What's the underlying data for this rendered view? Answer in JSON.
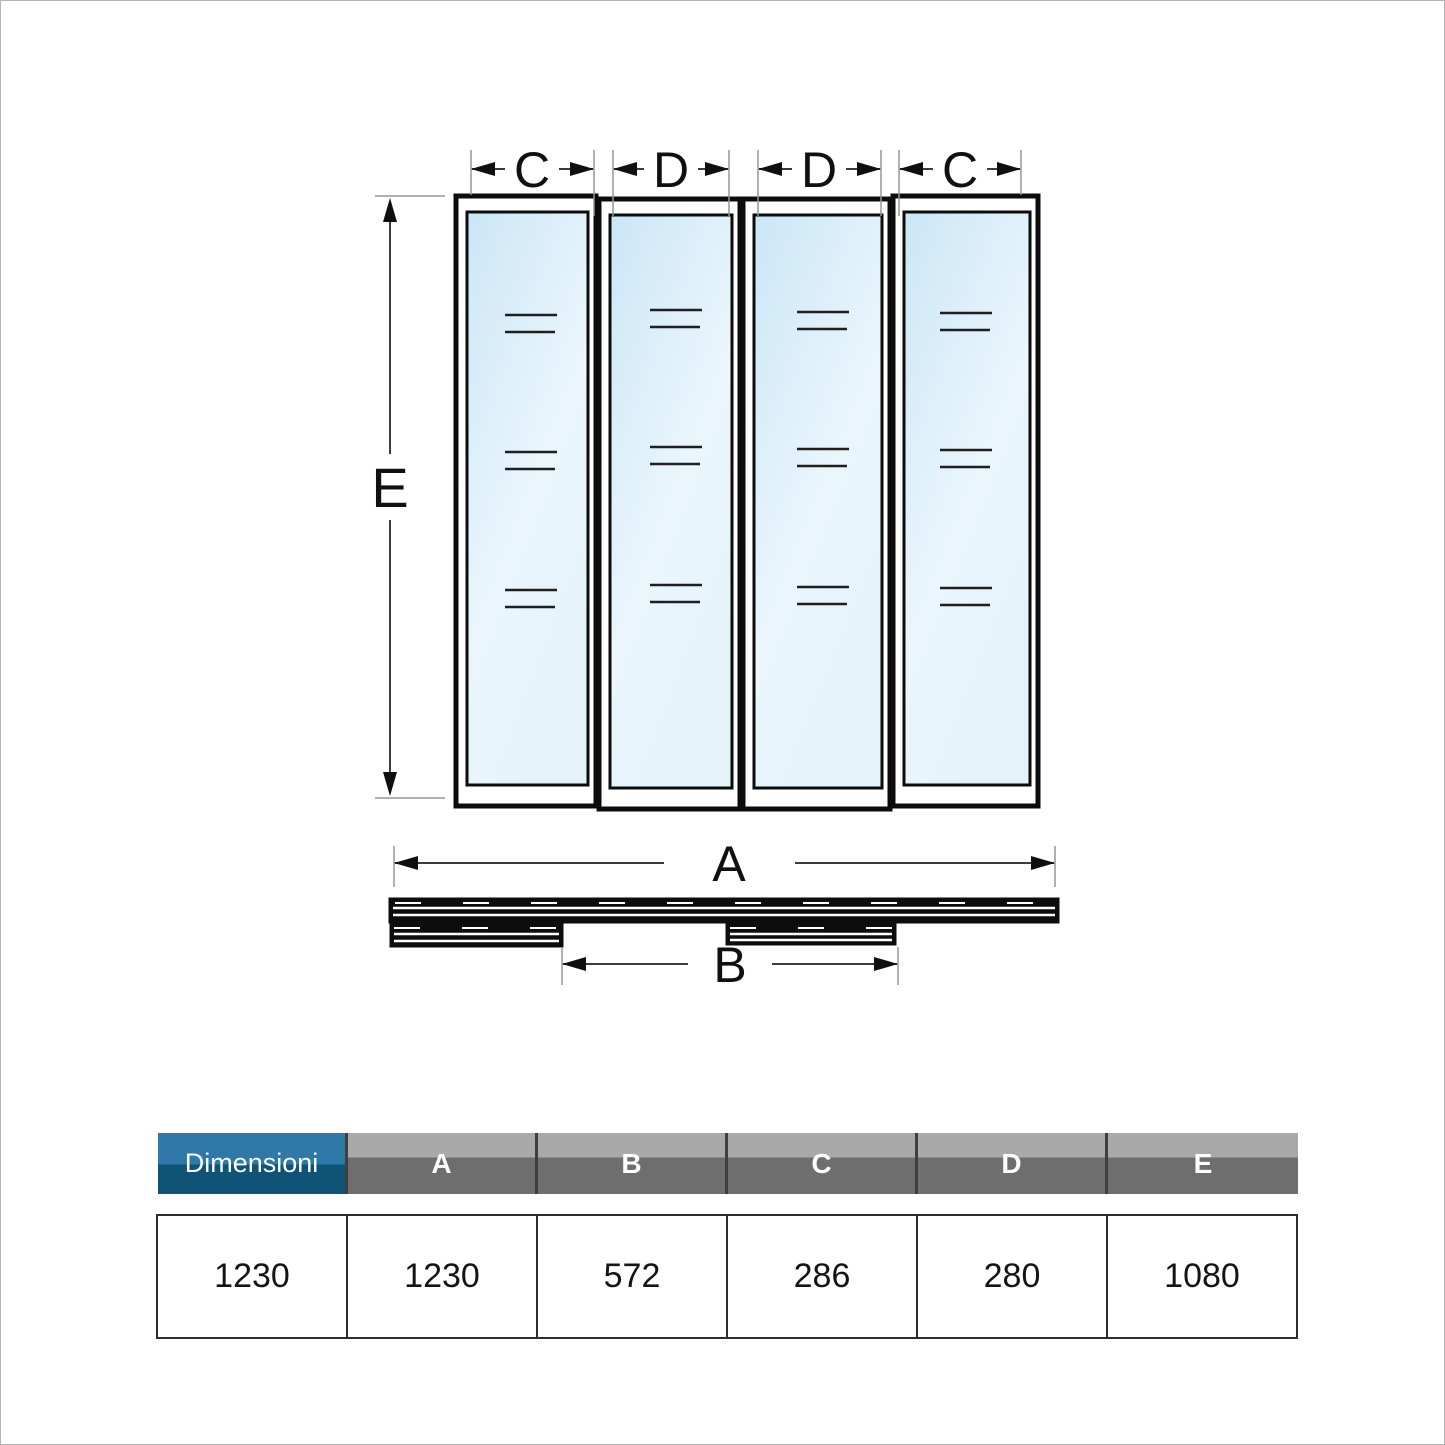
{
  "diagram": {
    "top_dimensions": [
      {
        "label": "C"
      },
      {
        "label": "D"
      },
      {
        "label": "D"
      },
      {
        "label": "C"
      }
    ],
    "height_dimension": {
      "label": "E"
    },
    "total_width_dimension": {
      "label": "A"
    },
    "opening_dimension": {
      "label": "B"
    }
  },
  "table": {
    "row_header": "Dimensioni",
    "columns": [
      "A",
      "B",
      "C",
      "D",
      "E"
    ],
    "values": [
      "1230",
      "1230",
      "572",
      "286",
      "280",
      "1080"
    ]
  },
  "colors": {
    "header_blue_top": "#2e79a7",
    "header_blue_bottom": "#0f5377",
    "header_gray_top": "#a9a9a9",
    "header_gray_bottom": "#6e6e6e",
    "glass_light": "#cbe6f6",
    "glass_mid": "#eaf6fc",
    "glass_lighter": "#e4f2fa",
    "frame_black": "#0c0c0c"
  }
}
